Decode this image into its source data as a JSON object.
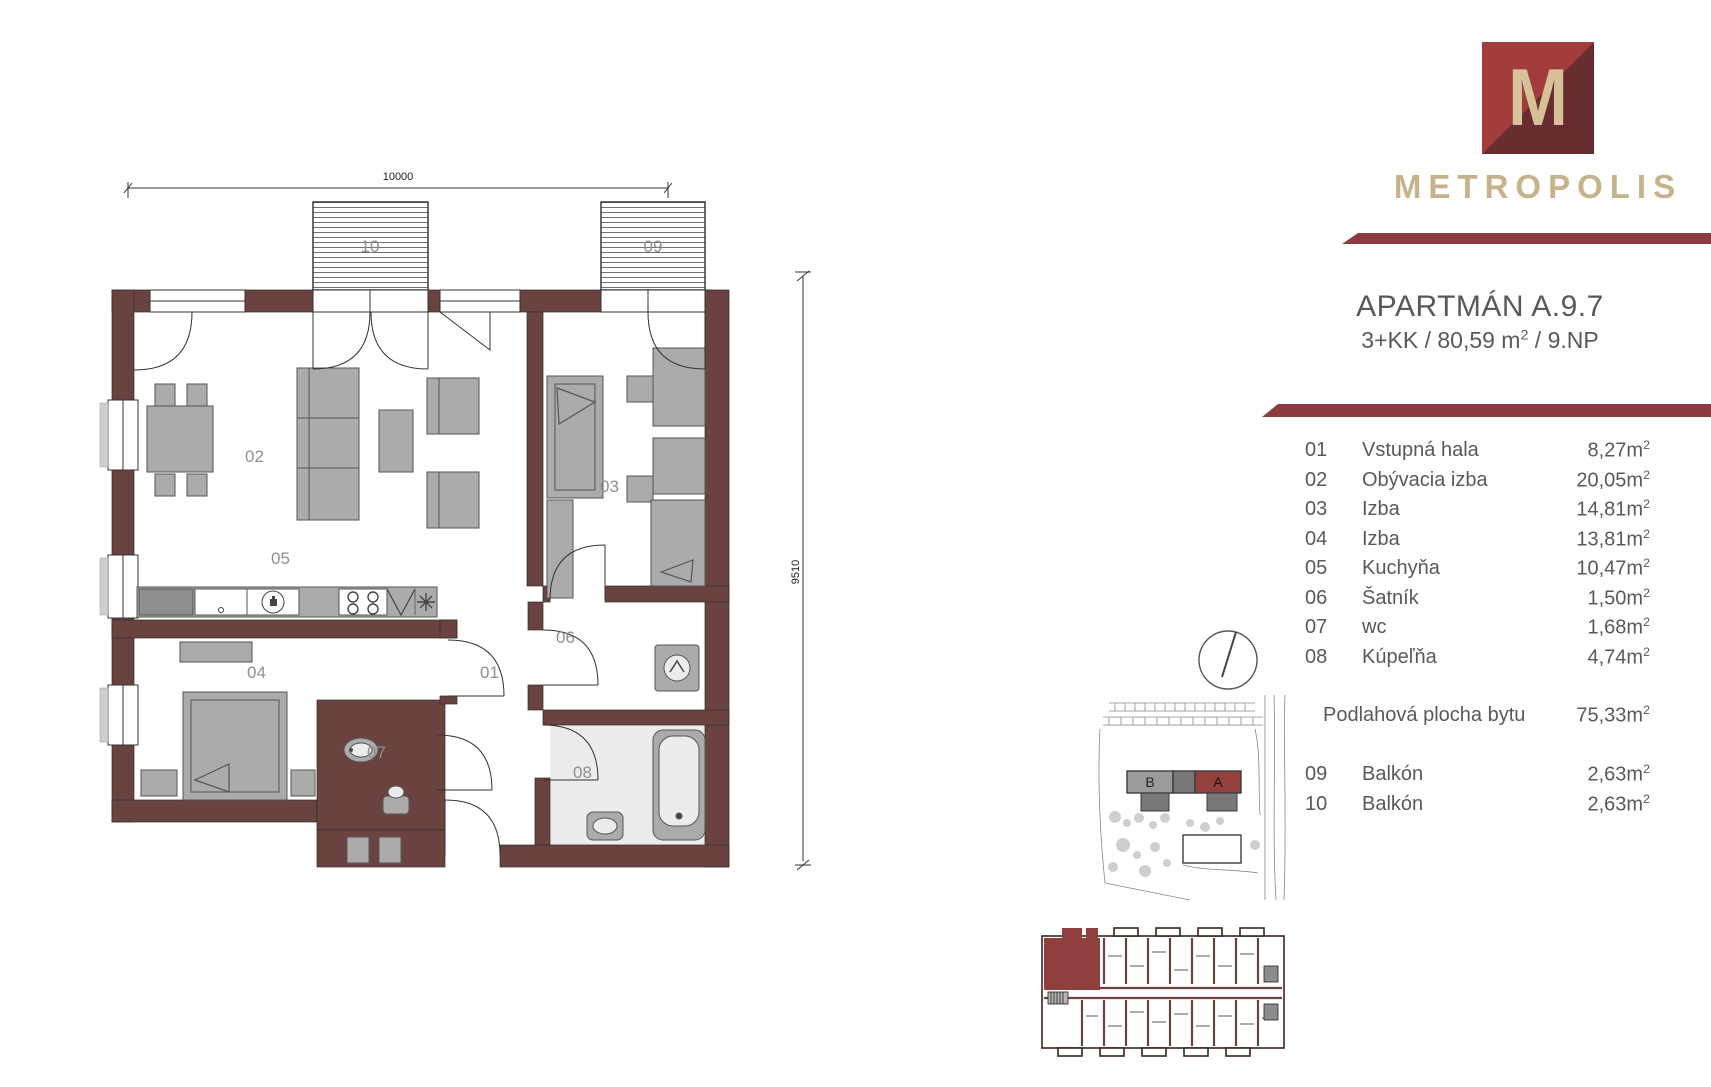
{
  "brand": {
    "logo_letter": "M",
    "name": "METROPOLIS"
  },
  "apartment": {
    "title": "APARTMÁN A.9.7",
    "subtitle_pre": "3+KK / 80,59 m",
    "subtitle_sup": "2",
    "subtitle_post": " / 9.NP"
  },
  "table": {
    "unit_base": "m",
    "unit_exp": "2",
    "rooms": [
      {
        "no": "01",
        "name": "Vstupná hala",
        "area": "8,27"
      },
      {
        "no": "02",
        "name": "Obývacia izba",
        "area": "20,05"
      },
      {
        "no": "03",
        "name": "Izba",
        "area": "14,81"
      },
      {
        "no": "04",
        "name": "Izba",
        "area": "13,81"
      },
      {
        "no": "05",
        "name": "Kuchyňa",
        "area": "10,47"
      },
      {
        "no": "06",
        "name": "Šatník",
        "area": "1,50"
      },
      {
        "no": "07",
        "name": "wc",
        "area": "1,68"
      },
      {
        "no": "08",
        "name": "Kúpeľňa",
        "area": "4,74"
      }
    ],
    "total": {
      "label": "Podlahová plocha bytu",
      "area": "75,33"
    },
    "balconies": [
      {
        "no": "09",
        "name": "Balkón",
        "area": "2,63"
      },
      {
        "no": "10",
        "name": "Balkón",
        "area": "2,63"
      }
    ]
  },
  "plan": {
    "dim_width": "10000",
    "dim_height": "9510",
    "balcony_left_label": "10",
    "balcony_right_label": "09",
    "rooms": {
      "r01": "01",
      "r02": "02",
      "r03": "03",
      "r04": "04",
      "r05": "05",
      "r06": "06",
      "r07": "07",
      "r08": "08"
    }
  },
  "site": {
    "building_b": "B",
    "building_a": "A"
  },
  "colors": {
    "wall": "#6a423f",
    "accent_bar": "#8d3b41",
    "logo_light": "#a23c3c",
    "logo_dark": "#662c2f",
    "beige": "#d8c098",
    "wordmark": "#c7b38b",
    "text": "#58595b",
    "highlight": "#8f3f3d"
  }
}
